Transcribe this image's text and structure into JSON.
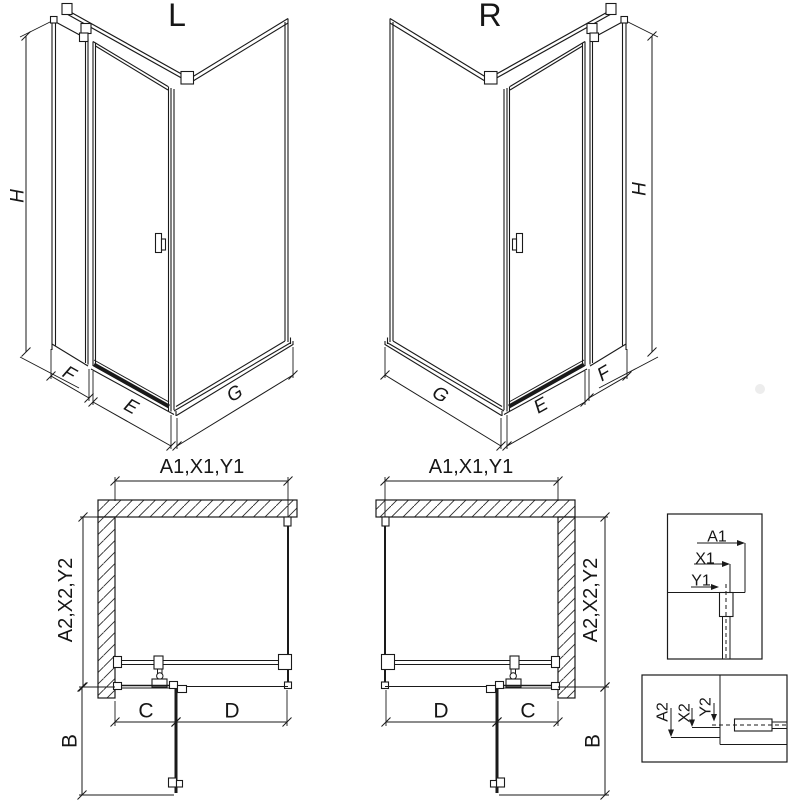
{
  "drawing": {
    "background": "#ffffff",
    "line_color": "#1a1a1a",
    "hatch_color": "#2a2a2a",
    "views": {
      "iso_left": {
        "title": "L",
        "height_dim": "H",
        "side_panel_dim": "F",
        "door_dim": "E",
        "return_panel_dim": "G"
      },
      "iso_right": {
        "title": "R",
        "height_dim": "H",
        "side_panel_dim": "F",
        "door_dim": "E",
        "return_panel_dim": "G"
      },
      "plan_left": {
        "width_dim": "A1,X1,Y1",
        "depth_dim": "A2,X2,Y2",
        "fixed_dim": "C",
        "opening_dim": "D",
        "door_proj_dim": "B"
      },
      "plan_right": {
        "width_dim": "A1,X1,Y1",
        "depth_dim": "A2,X2,Y2",
        "fixed_dim": "C",
        "opening_dim": "D",
        "door_proj_dim": "B"
      },
      "detail_width": {
        "labels": [
          "A1",
          "X1",
          "Y1"
        ]
      },
      "detail_depth": {
        "labels": [
          "A2",
          "X2",
          "Y2"
        ]
      }
    }
  }
}
